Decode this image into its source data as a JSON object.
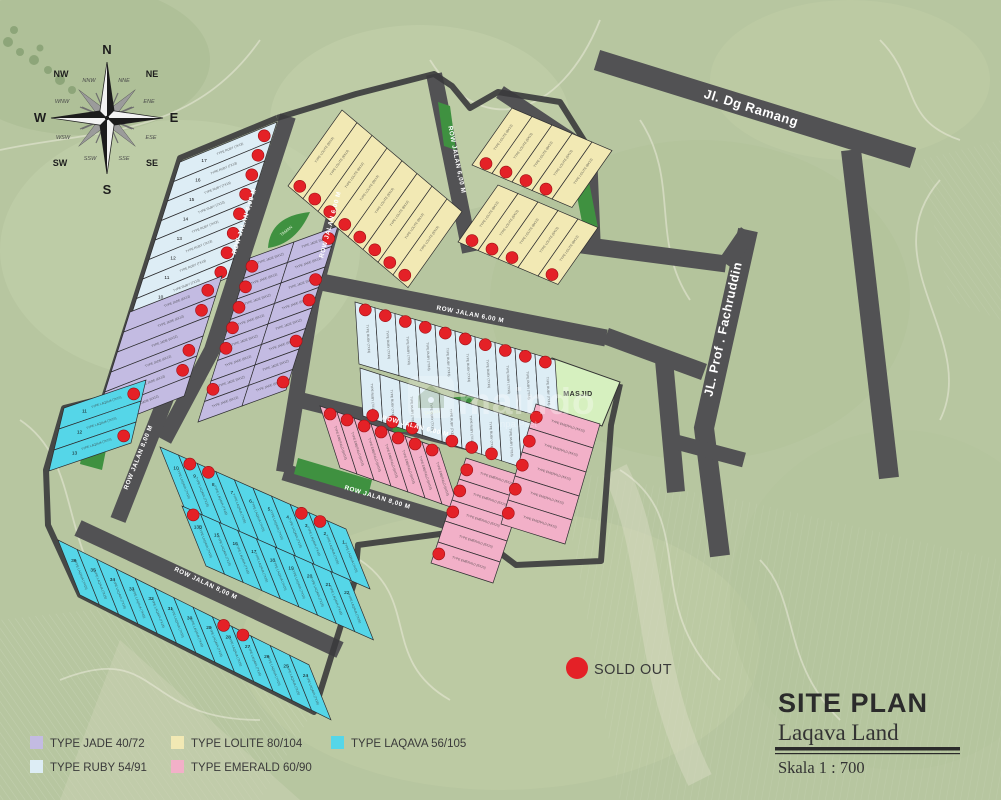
{
  "compass": {
    "n": "N",
    "s": "S",
    "e": "E",
    "w": "W",
    "ne": "NE",
    "nw": "NW",
    "se": "SE",
    "sw": "SW",
    "nne": "NNE",
    "ene": "ENE",
    "ese": "ESE",
    "sse": "SSE",
    "ssw": "SSW",
    "wsw": "WSW",
    "wnw": "WNW",
    "nnw": "NNW"
  },
  "roads": {
    "ramang": "Jl. Dg Ramang",
    "fachruddin": "JL. Prof . Fachruddin",
    "row6": "ROW JALAN 6,00 M",
    "row8": "ROW JALAN 8,00 M"
  },
  "areas": {
    "masjid": "MASJID",
    "taman": "TAMAN"
  },
  "watermark": {
    "text": "maindo",
    "sub": "npa Pilet"
  },
  "type_colors": {
    "jade": "#c3bbe2",
    "ruby": "#ddedf5",
    "lolite": "#f2e9b4",
    "emerald": "#f2b0c8",
    "laqava": "#55d6e8"
  },
  "sold_color": "#e42127",
  "sold_out_label": "SOLD OUT",
  "legend": {
    "items": [
      {
        "label": "TYPE JADE 40/72",
        "type": "jade"
      },
      {
        "label": "TYPE RUBY 54/91",
        "type": "ruby"
      },
      {
        "label": "TYPE LOLITE 80/104",
        "type": "lolite"
      },
      {
        "label": "TYPE EMERALD 60/90",
        "type": "emerald"
      },
      {
        "label": "TYPE LAQAVA 56/105",
        "type": "laqava"
      }
    ]
  },
  "title": {
    "line1": "SITE PLAN",
    "line2": "Laqava Land",
    "scale": "Skala 1 : 700"
  },
  "clusters": {
    "ruby-nw": {
      "type": "ruby",
      "type_label": "TYPE RUBY (7X13)",
      "count": 8,
      "numbers": [
        "17",
        "16",
        "15",
        "14",
        "13",
        "12",
        "11",
        "10"
      ],
      "sold": [
        0,
        1,
        2,
        3,
        4,
        5,
        6,
        7
      ]
    },
    "jade-left": {
      "type": "jade",
      "type_label": "TYPE JADE (6X12)",
      "count": 6,
      "sold": [
        0,
        1,
        3,
        4
      ]
    },
    "jade-mid-a": {
      "type": "jade",
      "type_label": "TYPE JADE (6X12)",
      "count": 8,
      "sold": [
        0,
        1,
        2,
        3,
        4,
        6
      ]
    },
    "jade-mid-b": {
      "type": "jade",
      "type_label": "TYPE JADE (6X12)",
      "count": 8,
      "sold": [
        0,
        2,
        3,
        5,
        7
      ]
    },
    "lolite-top": {
      "type": "lolite",
      "type_label": "TYPE LOLITE (8X13)",
      "count": 8,
      "sold": [
        0,
        1,
        2,
        3,
        4,
        5,
        6,
        7
      ]
    },
    "lolite-right-a": {
      "type": "lolite",
      "type_label": "TYPE LOLITE (8X13)",
      "count": 5,
      "sold": [
        0,
        1,
        2,
        3
      ]
    },
    "lolite-right-b": {
      "type": "lolite",
      "type_label": "TYPE LOLITE (8X13)",
      "count": 5,
      "sold": [
        0,
        1,
        2,
        4
      ]
    },
    "ruby-center-a": {
      "type": "ruby",
      "type_label": "TYPE RUBY (7X13)",
      "count": 10,
      "sold": [
        0,
        1,
        2,
        3,
        4,
        5,
        6,
        7,
        8,
        9
      ]
    },
    "ruby-center-b": {
      "type": "ruby",
      "type_label": "TYPE RUBY (7X13)",
      "count": 10,
      "sold": [
        0,
        1,
        2,
        4,
        5,
        6,
        8,
        9
      ]
    },
    "emerald-a": {
      "type": "emerald",
      "type_label": "TYPE EMERALD (6X15)",
      "count": 7,
      "sold": [
        0,
        1,
        2,
        3,
        4,
        5,
        6
      ]
    },
    "emerald-b": {
      "type": "emerald",
      "type_label": "TYPE EMERALD (6X15)",
      "count": 5,
      "sold": [
        0,
        1,
        2,
        4
      ]
    },
    "emerald-masjid": {
      "type": "emerald",
      "type_label": "TYPE EMERALD (6X15)",
      "count": 5,
      "sold": [
        0,
        1,
        2,
        3,
        4
      ]
    },
    "laqava-row0": {
      "type": "laqava",
      "type_label": "TYPE LAQAVA (7X15)",
      "count": 3,
      "numbers": [
        "11",
        "12",
        "13"
      ],
      "sold": [
        0,
        2
      ]
    },
    "laqava-row1": {
      "type": "laqava",
      "type_label": "TYPE LAQAVA (7X15)",
      "count": 10,
      "numbers": [
        "10",
        "9",
        "8",
        "7",
        "6",
        "5",
        "4",
        "3",
        "2",
        "1"
      ],
      "sold": [
        1,
        2,
        7,
        8
      ]
    },
    "laqava-row2": {
      "type": "laqava",
      "type_label": "TYPE LAQAVA (7X15)",
      "count": 9,
      "numbers": [
        "13B",
        "15",
        "16",
        "17",
        "18",
        "19",
        "20",
        "21",
        "22"
      ],
      "sold": [
        0
      ]
    },
    "laqava-row3": {
      "type": "laqava",
      "type_label": "TYPE LAQAVA (7X15)",
      "count": 13,
      "numbers": [
        "36",
        "35",
        "34",
        "33",
        "32",
        "31",
        "30",
        "29",
        "28",
        "27",
        "26",
        "25",
        "24"
      ],
      "sold": [
        8,
        9
      ]
    }
  }
}
